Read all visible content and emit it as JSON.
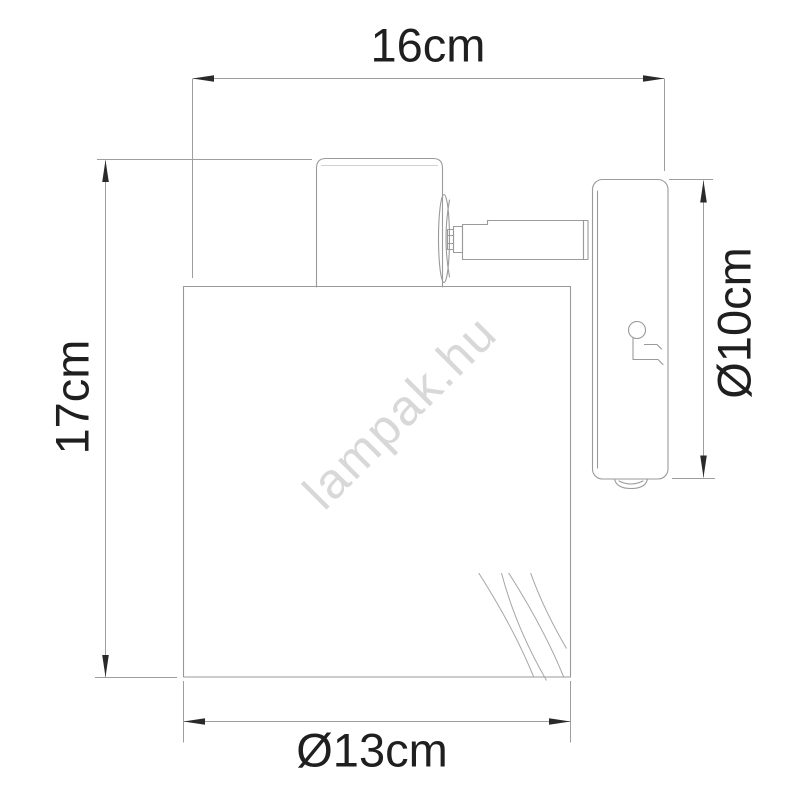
{
  "drawing": {
    "watermark": {
      "text": "lampak.hu"
    },
    "dimensions": {
      "total_width": {
        "label": "16cm",
        "value": 16,
        "unit": "cm"
      },
      "total_height": {
        "label": "17cm",
        "value": 17,
        "unit": "cm"
      },
      "shade_diameter": {
        "label": "Ø13cm",
        "value": 13,
        "unit": "cm"
      },
      "backplate_diameter": {
        "label": "Ø10cm",
        "value": 10,
        "unit": "cm"
      }
    }
  },
  "colors": {
    "line": "#9a9a9a",
    "dim-line": "#9e9e9e",
    "faint": "#d0d0d0",
    "text": "#1f1f1f",
    "arrow": "#2a2a2a",
    "watermark": "#d8d8d8",
    "background": "#ffffff"
  }
}
